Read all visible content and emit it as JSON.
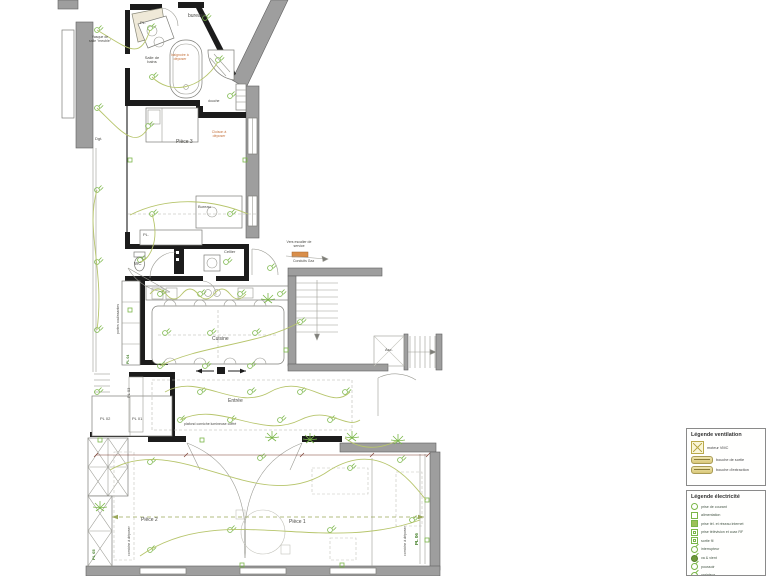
{
  "colors": {
    "wall_existing": "#9e9e9e",
    "wall_new": "#1c1c1c",
    "electric_green": "#7ab648",
    "wiring_olive": "#b7c56c",
    "demolition_orange": "#c4703a",
    "dimension_red": "#7a3b2e",
    "furniture_beige": "#efe9d8"
  },
  "plan": {
    "labels": {
      "bureaux": "bureaux",
      "pl_top": "PL.",
      "vasque": "Vasque de salle \"meuble\"",
      "salle_de_bains": "Salle de bains",
      "baignoire": "baignoire à déposer",
      "douche": "douche",
      "dgt": "Dgt.",
      "piece3": "Pièce 3",
      "cloison": "Cloison à déposer",
      "bureau": "Bureau",
      "pl_piece3": "PL.",
      "wc": "WC",
      "cellier": "Cellier",
      "vers_escalier": "Vers escalier de service",
      "conduits_gaz": "Conduits Gaz",
      "cuisine": "Cuisine",
      "asc": "Asc.",
      "portes_coulissantes": "portes coulissantes",
      "pl04": "PL 04",
      "pl03": "PL 03",
      "pl02": "PL 02",
      "pl01": "PL 01",
      "entree": "Entrée",
      "plafond": "plafond corniche lumineuse coffré",
      "piece2": "Pièce 2",
      "piece1": "Pièce 1",
      "corniche_left": "corniche à déposer",
      "corniche_right": "corniche à déposer",
      "pl05": "PL 05",
      "pl06": "PL 06"
    }
  },
  "legend_ventilation": {
    "title": "Légende ventilation",
    "items": [
      {
        "icon": "vmc-unit-icon",
        "label": "moteur VMC"
      },
      {
        "icon": "duct-outlet-icon",
        "label": "bouche de sortie"
      },
      {
        "icon": "duct-extract-icon",
        "label": "bouche d'extraction"
      }
    ]
  },
  "legend_electricite": {
    "title": "Légende électricité",
    "items": [
      {
        "icon": "socket-icon",
        "label": "prise de courant"
      },
      {
        "icon": "supply-icon",
        "label": "alimentation"
      },
      {
        "icon": "network-socket-icon",
        "label": "prise tél. et réseau internet"
      },
      {
        "icon": "tv-socket-icon",
        "label": "prise télévision et coax RF"
      },
      {
        "icon": "wire-outlet-icon",
        "label": "sortie fil"
      },
      {
        "icon": "switch-icon",
        "label": "interrupteur"
      },
      {
        "icon": "two-way-switch-icon",
        "label": "va & vient"
      },
      {
        "icon": "push-button-icon",
        "label": "poussoir"
      },
      {
        "icon": "dimmer-icon",
        "label": "variateur"
      },
      {
        "icon": "shutter-control-icon",
        "label": "commande de volet roulant"
      },
      {
        "icon": "timer-push-icon",
        "label": "poussoir minuterie"
      }
    ]
  }
}
